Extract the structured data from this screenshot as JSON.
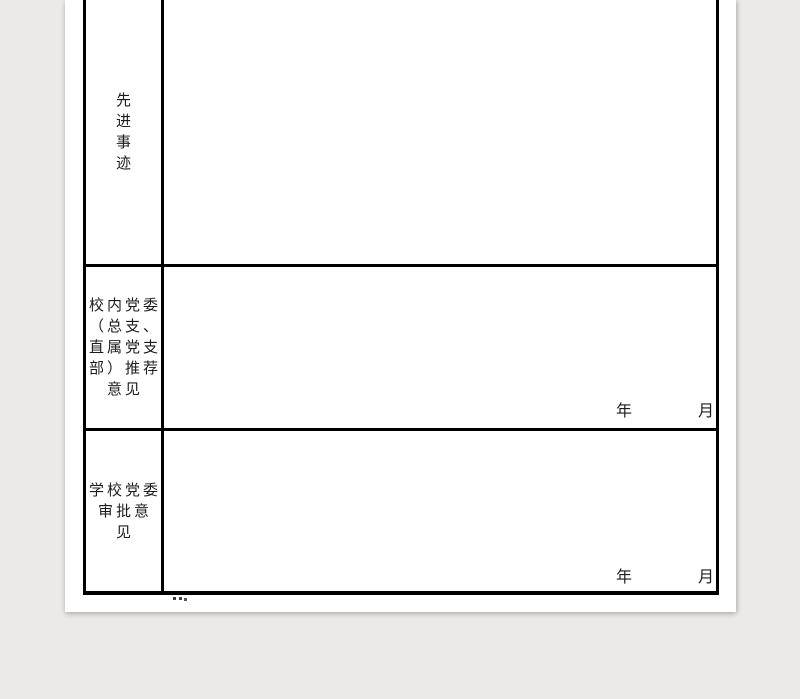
{
  "page": {
    "background_color": "#ECEAE8",
    "paper_color": "#FFFFFF",
    "border_color": "#000000",
    "text_color": "#1C1C1C"
  },
  "table": {
    "rows": [
      {
        "label": "先进事迹",
        "label_chars": [
          "先",
          "进",
          "事",
          "迹"
        ],
        "content": ""
      },
      {
        "label": "校内党委（总支、直属党支部）推荐意见",
        "label_lines": [
          "校内党委",
          "（总支、",
          "直属党支",
          "部）推荐",
          "意见"
        ],
        "content": "",
        "date": {
          "year_label": "年",
          "month_label": "月"
        }
      },
      {
        "label": "学校党委审批意见",
        "label_lines": [
          "学校党委",
          "审批意",
          "见"
        ],
        "content": "",
        "date": {
          "year_label": "年",
          "month_label": "月"
        }
      }
    ]
  }
}
